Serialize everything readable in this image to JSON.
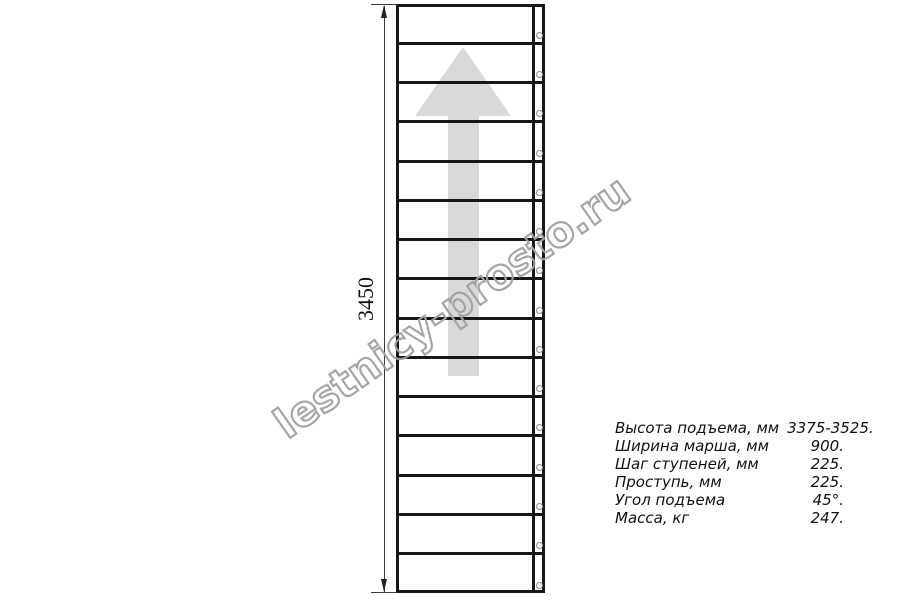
{
  "colors": {
    "line": "#161616",
    "dim_line": "#3c3c3c",
    "arrow_fill": "#d9d9d9",
    "watermark_stroke": "#a2a2a2",
    "hole_stroke": "#8c8c8c",
    "text": "#111111"
  },
  "diagram": {
    "dimension_label": "3450",
    "watermark_text": "lestnicy-prosto.ru",
    "arrow_direction": "up",
    "stairs": {
      "steps_count": 15,
      "holes_count": 15
    }
  },
  "specs": {
    "rows": [
      {
        "label": "Высота подъема, мм",
        "value": "3375-3525."
      },
      {
        "label": "Ширина марша, мм",
        "value": "900."
      },
      {
        "label": "Шаг ступеней, мм",
        "value": "225."
      },
      {
        "label": "Проступь, мм",
        "value": "225."
      },
      {
        "label": "Угол подъема",
        "value": "45°."
      },
      {
        "label": "Масса, кг",
        "value": "247."
      }
    ]
  }
}
